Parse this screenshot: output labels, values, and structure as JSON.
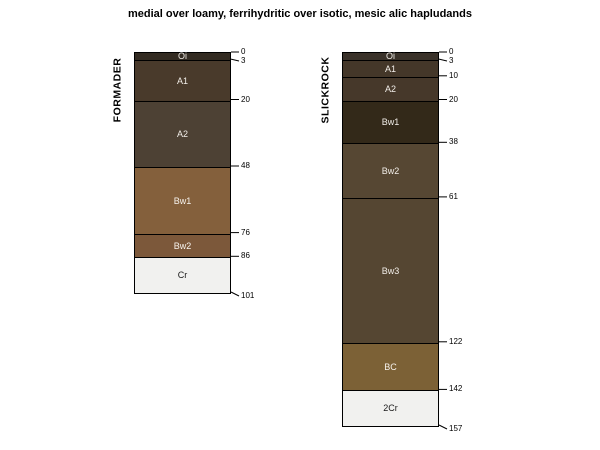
{
  "title": "medial over loamy, ferrihydritic over isotic, mesic alic hapludands",
  "chart_data": {
    "type": "soil-profile-sketch",
    "depth_unit": "cm",
    "px_per_cm": 2.3758,
    "top_y": 52,
    "line_color": "#000000",
    "background": "#ffffff",
    "profiles": [
      {
        "id": "FORMADER",
        "left": 134,
        "width": 97,
        "horizons": [
          {
            "name": "Oi",
            "top": 0,
            "bottom": 3,
            "color": "#332b22",
            "text_color": "#f2eee9"
          },
          {
            "name": "A1",
            "top": 3,
            "bottom": 20,
            "color": "#493a2b",
            "text_color": "#f2eee9"
          },
          {
            "name": "A2",
            "top": 20,
            "bottom": 48,
            "color": "#4d4134",
            "text_color": "#f2eee9"
          },
          {
            "name": "Bw1",
            "top": 48,
            "bottom": 76,
            "color": "#84603c",
            "text_color": "#f7f3ee"
          },
          {
            "name": "Bw2",
            "top": 76,
            "bottom": 86,
            "color": "#7c583a",
            "text_color": "#f7f3ee"
          },
          {
            "name": "Cr",
            "top": 86,
            "bottom": 101,
            "color": "#f1f1ef",
            "text_color": "#1a1a1a"
          }
        ],
        "depth_labels": [
          0,
          3,
          20,
          48,
          76,
          86,
          101
        ]
      },
      {
        "id": "SLICKROCK",
        "left": 342,
        "width": 97,
        "horizons": [
          {
            "name": "Oi",
            "top": 0,
            "bottom": 3,
            "color": "#3a322a",
            "text_color": "#f2eee9"
          },
          {
            "name": "A1",
            "top": 3,
            "bottom": 10,
            "color": "#443729",
            "text_color": "#f2eee9"
          },
          {
            "name": "A2",
            "top": 10,
            "bottom": 20,
            "color": "#46382a",
            "text_color": "#f2eee9"
          },
          {
            "name": "Bw1",
            "top": 20,
            "bottom": 38,
            "color": "#332919",
            "text_color": "#f2eee9"
          },
          {
            "name": "Bw2",
            "top": 38,
            "bottom": 61,
            "color": "#564733",
            "text_color": "#f2eee9"
          },
          {
            "name": "Bw3",
            "top": 61,
            "bottom": 122,
            "color": "#554632",
            "text_color": "#f2eee9"
          },
          {
            "name": "BC",
            "top": 122,
            "bottom": 142,
            "color": "#7c6136",
            "text_color": "#f7f3ee"
          },
          {
            "name": "2Cr",
            "top": 142,
            "bottom": 157,
            "color": "#f1f1ef",
            "text_color": "#1a1a1a"
          }
        ],
        "depth_labels": [
          0,
          3,
          10,
          20,
          38,
          61,
          122,
          142,
          157
        ]
      }
    ]
  }
}
